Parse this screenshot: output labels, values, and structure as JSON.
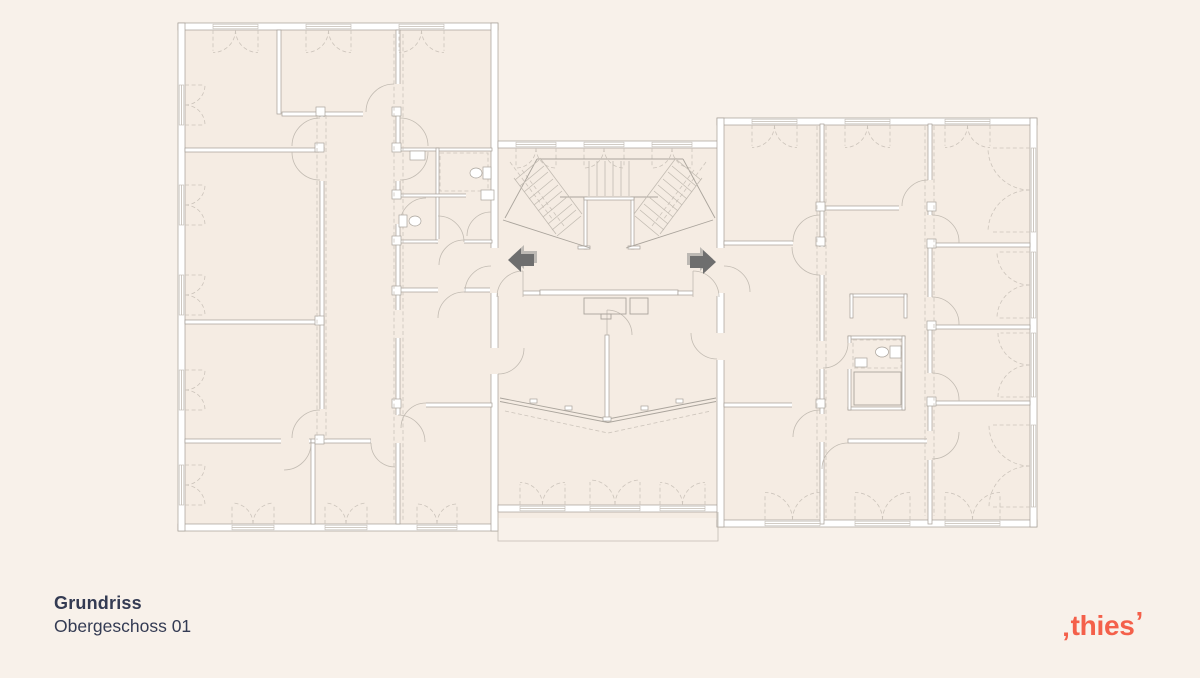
{
  "title_block": {
    "heading": "Grundriss",
    "subheading": "Obergeschoss 01"
  },
  "logo": {
    "open_mark": "‚",
    "text": "thies",
    "close_mark": "’"
  },
  "plan": {
    "type": "architectural-floor-plan",
    "floor_label": "Obergeschoss 01",
    "icons": {
      "left": "arrow-left-icon",
      "right": "arrow-right-icon"
    }
  },
  "colors": {
    "page_bg": "#f8f1ea",
    "room_fill": "#f5ece3",
    "wall_stroke": "#a59e96",
    "line": "#aaa49c",
    "line_light": "#c2bbb2",
    "dashed": "#ccc4bb",
    "arrow": "#6e6e6e",
    "arrow_shadow": "#bdb9b4",
    "heading_text": "#343b53",
    "logo_accent": "#f4604a"
  }
}
